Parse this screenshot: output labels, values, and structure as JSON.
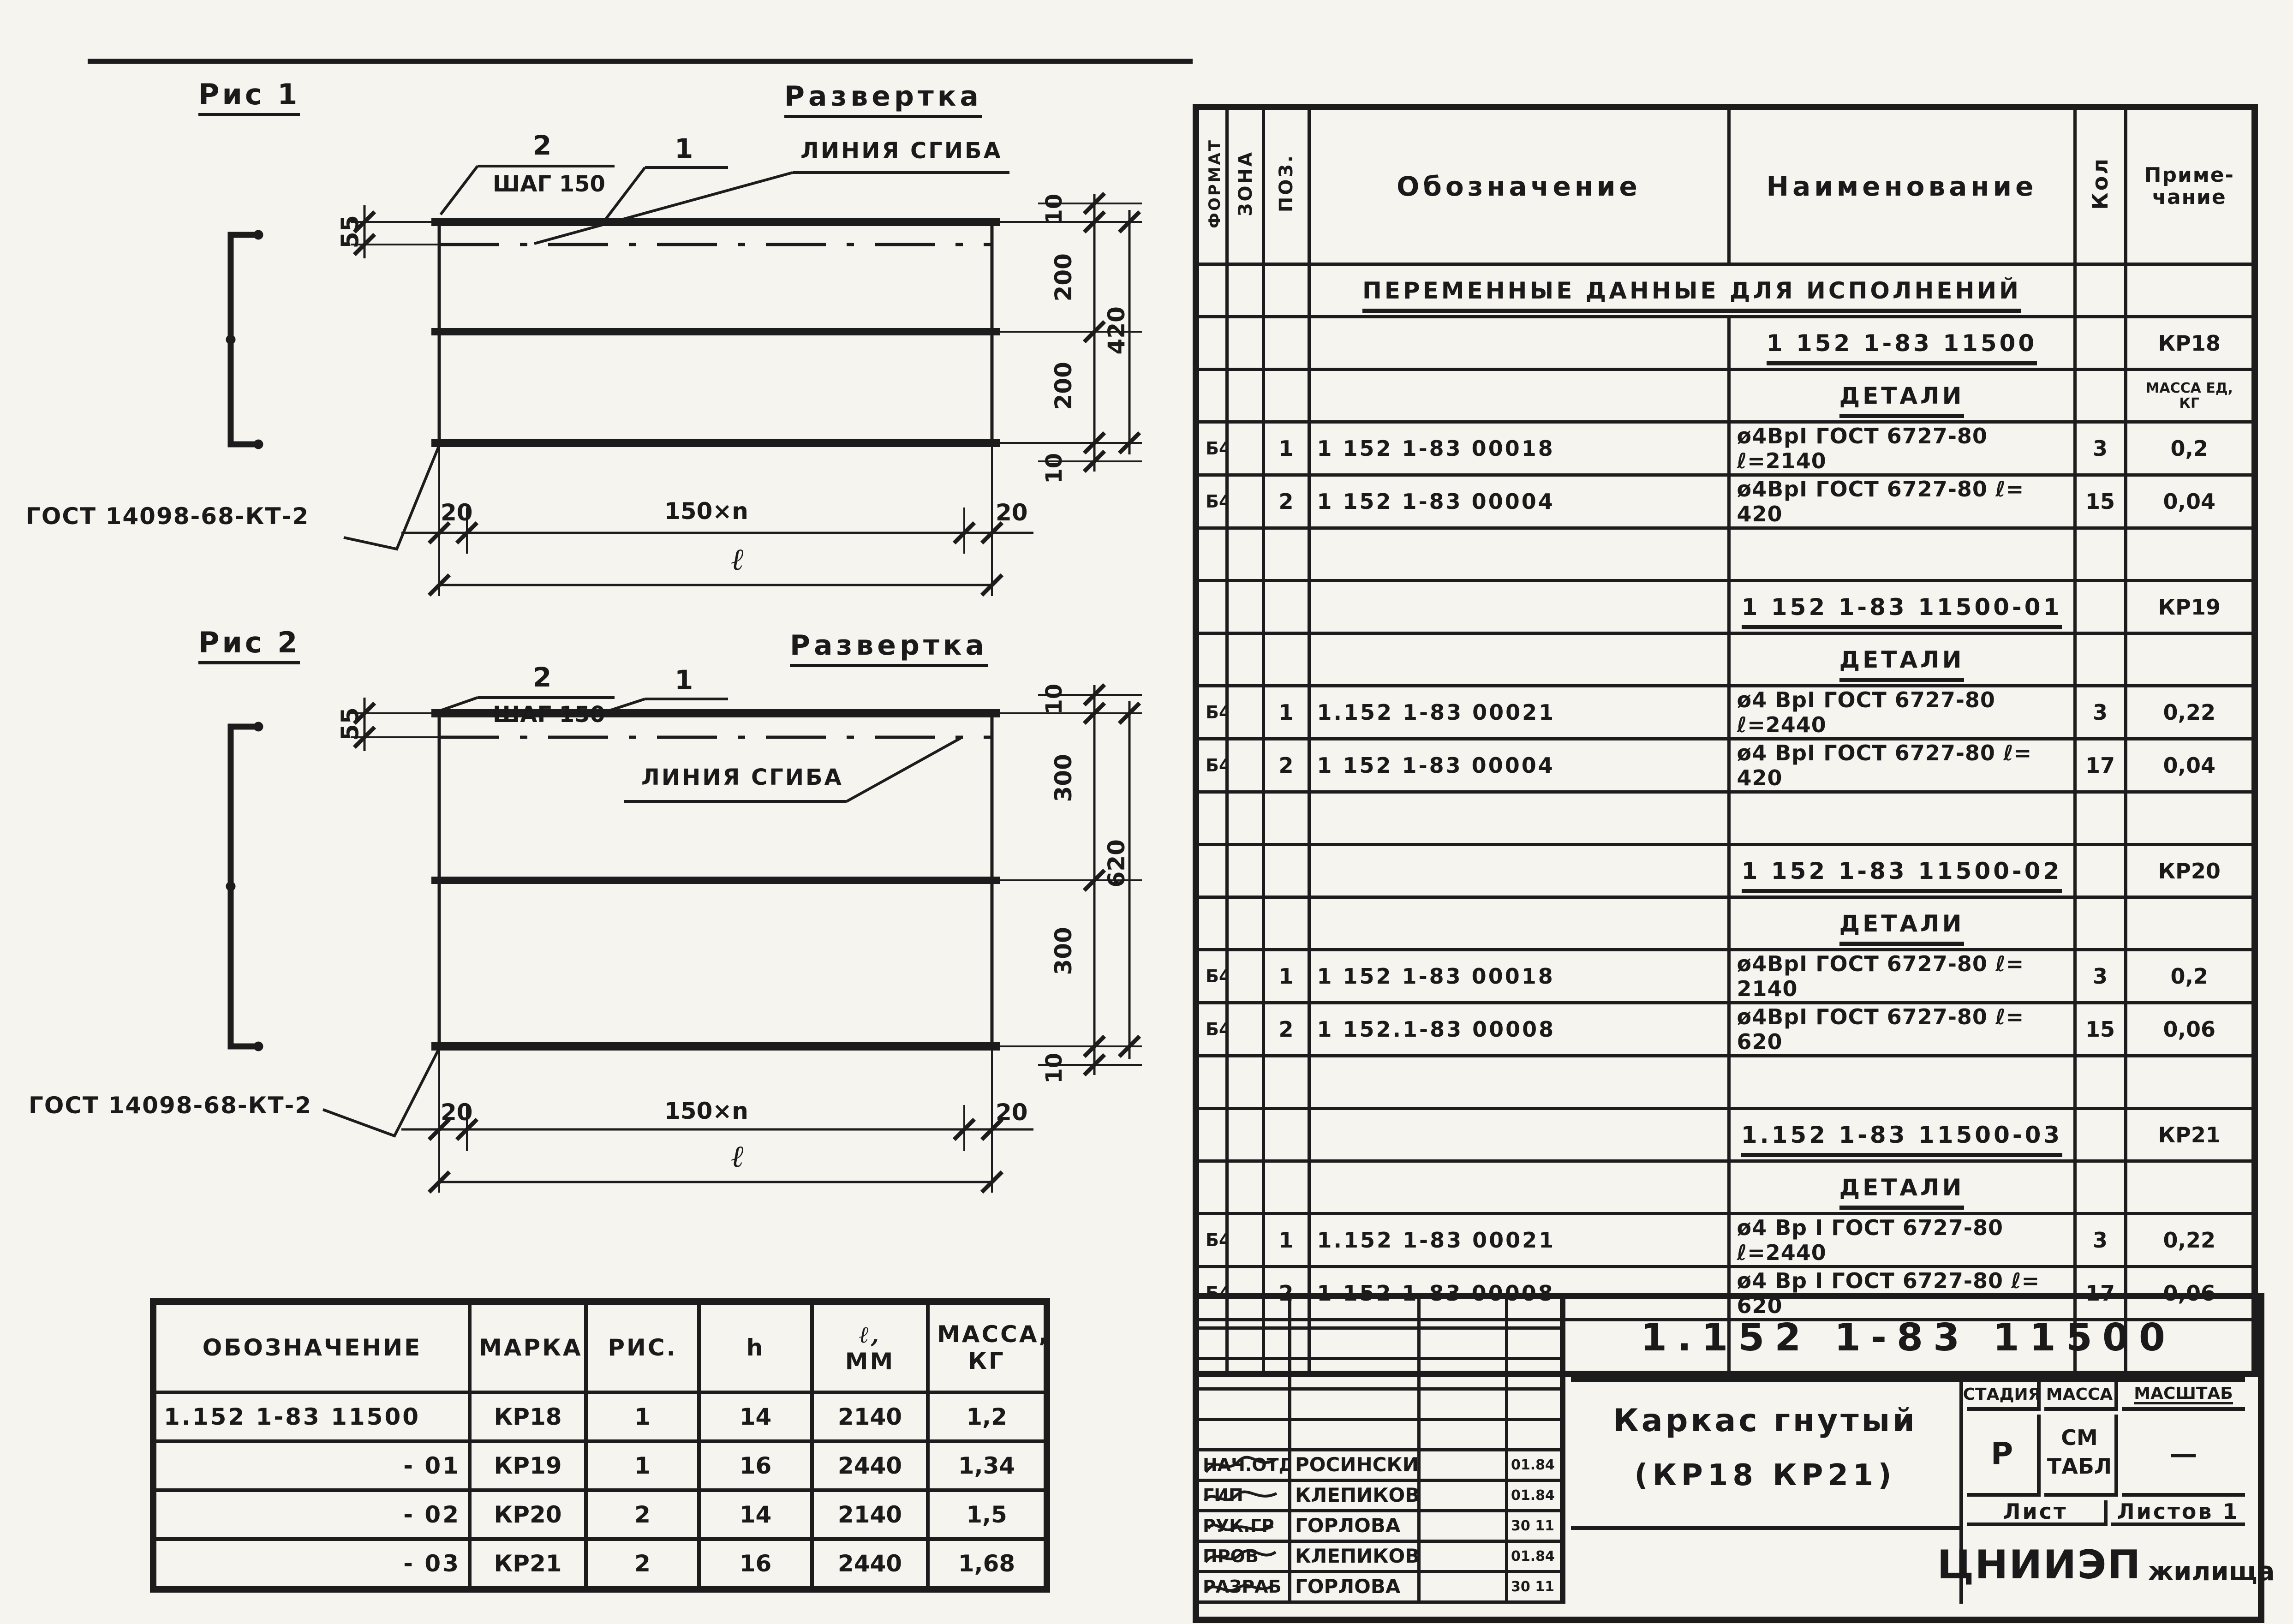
{
  "figures": {
    "fig1": {
      "title": "Рис 1",
      "view": "Развертка",
      "pos2": "2",
      "step": "ШАГ 150",
      "pos1": "1",
      "fold": "ЛИНИЯ СГИБА",
      "weld": "ГОСТ 14098-68-КТ-2",
      "dim_left": "55",
      "dim_t10": "10",
      "dim_top": "200",
      "dim_all": "420",
      "dim_bot": "200",
      "dim_b10": "10",
      "dim_20l": "20",
      "dim_mid": "150×n",
      "dim_20r": "20",
      "dim_len": "ℓ"
    },
    "fig2": {
      "title": "Рис 2",
      "view": "Развертка",
      "pos2": "2",
      "step": "ШАГ 150",
      "pos1": "1",
      "fold": "ЛИНИЯ СГИБА",
      "weld": "ГОСТ 14098-68-КТ-2",
      "dim_left": "55",
      "dim_t10": "10",
      "dim_top": "300",
      "dim_all": "620",
      "dim_bot": "300",
      "dim_b10": "10",
      "dim_20l": "20",
      "dim_mid": "150×n",
      "dim_20r": "20",
      "dim_len": "ℓ"
    }
  },
  "params_table": {
    "col_designation": "ОБОЗНАЧЕНИЕ",
    "col_mark": "МАРКА",
    "col_fig": "РИС.",
    "col_h": "h",
    "col_l1": "ℓ,",
    "col_l2": "ММ",
    "col_m1": "МАССА,",
    "col_m2": "КГ",
    "rows": [
      {
        "designation": "1.152 1-83   11500",
        "mark": "КР18",
        "fig": "1",
        "h": "14",
        "l": "2140",
        "mass": "1,2"
      },
      {
        "designation": "- 01",
        "mark": "КР19",
        "fig": "1",
        "h": "16",
        "l": "2440",
        "mass": "1,34"
      },
      {
        "designation": "- 02",
        "mark": "КР20",
        "fig": "2",
        "h": "14",
        "l": "2140",
        "mass": "1,5"
      },
      {
        "designation": "- 03",
        "mark": "КР21",
        "fig": "2",
        "h": "16",
        "l": "2440",
        "mass": "1,68"
      }
    ]
  },
  "spec": {
    "h_format": "ФОРМАТ",
    "h_zone": "ЗОНА",
    "h_pos": "ПОЗ.",
    "h_designation": "Обозначение",
    "h_name": "Наименование",
    "h_qty": "Кол",
    "h_note1": "Приме-",
    "h_note2": "чание",
    "rows": [
      {
        "name": "ПЕРЕМЕННЫЕ ДАННЫЕ ДЛЯ ИСПОЛНЕНИЙ"
      },
      {
        "name": "1 152 1-83  11500",
        "note": "КР18"
      },
      {
        "name": "ДЕТАЛИ",
        "note": "МАССА ЕД, КГ"
      },
      {
        "format": "Б4",
        "pos": "1",
        "designation": "1 152 1-83   00018",
        "name": "ø4ВрI ГОСТ 6727-80  ℓ=2140",
        "qty": "3",
        "note": "0,2"
      },
      {
        "format": "Б4",
        "pos": "2",
        "designation": "1 152 1-83  00004",
        "name": "ø4ВрI ГОСТ 6727-80  ℓ= 420",
        "qty": "15",
        "note": "0,04"
      },
      {},
      {
        "name": "1 152 1-83  11500-01",
        "note": "КР19"
      },
      {
        "name": "ДЕТАЛИ"
      },
      {
        "format": "Б4",
        "pos": "1",
        "designation": "1.152 1-83   00021",
        "name": "ø4 ВрI ГОСТ 6727-80  ℓ=2440",
        "qty": "3",
        "note": "0,22"
      },
      {
        "format": "Б4",
        "pos": "2",
        "designation": "1 152 1-83   00004",
        "name": "ø4 ВрI ГОСТ 6727-80  ℓ= 420",
        "qty": "17",
        "note": "0,04"
      },
      {},
      {
        "name": "1 152 1-83  11500-02",
        "note": "КР20"
      },
      {
        "name": "ДЕТАЛИ"
      },
      {
        "format": "Б4",
        "pos": "1",
        "designation": "1 152 1-83  00018",
        "name": "ø4ВрI ГОСТ 6727-80  ℓ= 2140",
        "qty": "3",
        "note": "0,2"
      },
      {
        "format": "Б4",
        "pos": "2",
        "designation": "1 152.1-83  00008",
        "name": "ø4ВрI ГОСТ 6727-80  ℓ= 620",
        "qty": "15",
        "note": "0,06"
      },
      {},
      {
        "name": "1.152 1-83  11500-03",
        "note": "КР21"
      },
      {
        "name": "ДЕТАЛИ"
      },
      {
        "format": "Б4",
        "pos": "1",
        "designation": "1.152 1-83  00021",
        "name": "ø4 Вр I ГОСТ 6727-80 ℓ=2440",
        "qty": "3",
        "note": "0,22"
      },
      {
        "format": "Б4",
        "pos": "2",
        "designation": "1 152 1-83  00008",
        "name": "ø4 Вр I ГОСТ 6727-80 ℓ= 620",
        "qty": "17",
        "note": "0,06"
      },
      {}
    ]
  },
  "title_block": {
    "designation": "1.152 1-83   11500",
    "product_name_line1": "Каркас гнутый",
    "product_name_line2": "(КР18  КР21)",
    "stage_label": "СТАДИЯ",
    "mass_label": "МАССА",
    "scale_label": "МАСШТАБ",
    "stage_value": "Р",
    "mass_value_1": "СМ",
    "mass_value_2": "ТАБЛ",
    "scale_value": "—",
    "sheet_label": "Лист",
    "sheets_label": "Листов 1",
    "org_name_1": "ЦНИИЭП",
    "org_name_2": "жилища",
    "signatures": [
      {
        "role": "НАЧ.ОТД",
        "name": "РОСИНСКИЙ",
        "date": "01.84"
      },
      {
        "role": "ГИП",
        "name": "КЛЕПИКОВА",
        "date": "01.84"
      },
      {
        "role": "РУК.ГР",
        "name": "ГОРЛОВА",
        "date": "30 11 83"
      },
      {
        "role": "ПРОВ",
        "name": "КЛЕПИКОВА",
        "date": "01.84"
      },
      {
        "role": "РАЗРАБ",
        "name": "ГОРЛОВА",
        "date": "30 11 83"
      }
    ]
  }
}
